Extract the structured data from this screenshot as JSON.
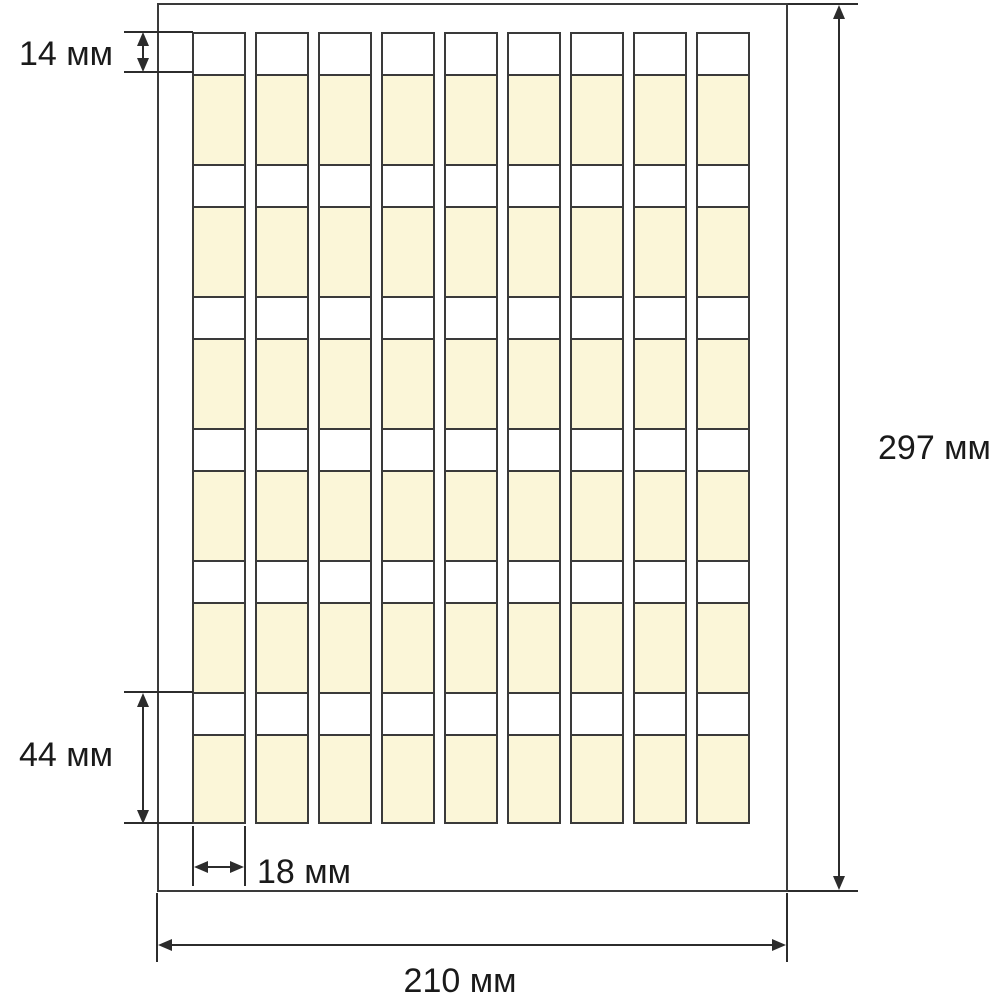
{
  "sheet": {
    "grid": {
      "columns": 9,
      "rows": 6
    },
    "colors": {
      "background": "#ffffff",
      "label_strip": "#ffffff",
      "label_body": "#fbf6d8",
      "grid_line": "#3a3a3a",
      "dimension_line": "#2c2c2c"
    }
  },
  "annotations": {
    "strip_height": "14 мм",
    "label_height": "44 мм",
    "label_width": "18 мм",
    "sheet_height": "297 мм",
    "sheet_width": "210 мм"
  }
}
